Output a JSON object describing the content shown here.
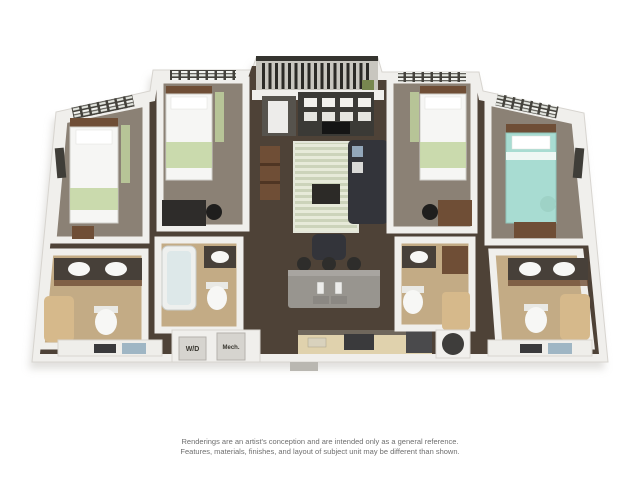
{
  "floor_plan": {
    "closet_labels": {
      "washer_dryer": "W/D",
      "mechanical": "Mech."
    }
  },
  "disclaimer": {
    "line1": "Renderings are an artist's conception and are intended only as a general reference.",
    "line2": "Features, materials, finishes, and layout of subject unit may be different than shown."
  },
  "colors": {
    "background": "#ffffff",
    "wall": "#f0efec",
    "wall-edge": "#d7d4cf",
    "floor-wood": "#4e4237",
    "carpet": "#8b8175",
    "bath-floor": "#c3ab85",
    "counter-tan": "#e0d2ad",
    "island-gray": "#98958f",
    "sofa-dark": "#33343a",
    "bed-white": "#f6f6f4",
    "bed-green": "#c2d5a0",
    "bed-teal": "#a8dcd2",
    "wood": "#6f4e36",
    "dark-frame": "#3f3d38",
    "railing": "#2b2a26",
    "curtain-tan": "#d6b98b",
    "white-fixture": "#f7f7f5",
    "door-gray": "#d6d4cf",
    "text-gray": "#6e6e6e",
    "shadow": "#c9c7c2"
  }
}
